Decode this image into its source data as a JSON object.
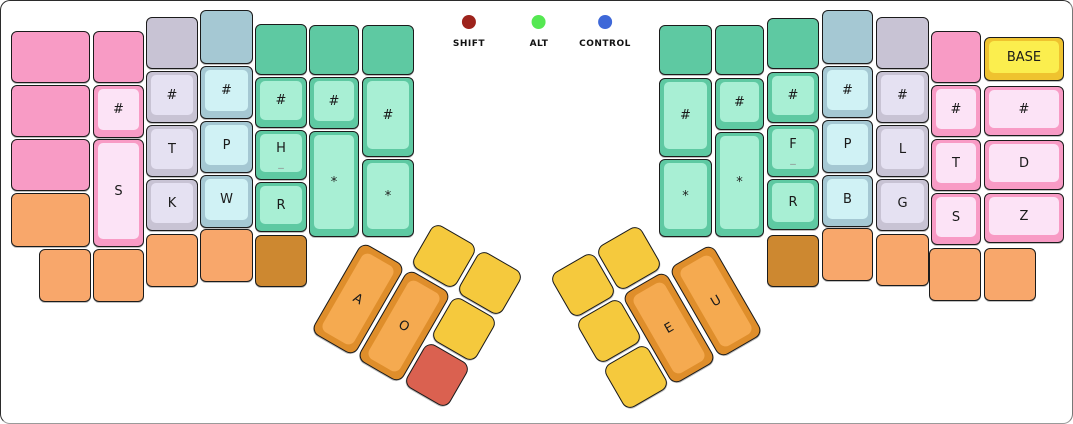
{
  "legend": {
    "indicators": [
      {
        "id": "shift",
        "label": "SHIFT",
        "color": "#9d231c",
        "x": 468
      },
      {
        "id": "alt",
        "label": "ALT",
        "color": "#55e852",
        "x": 538
      },
      {
        "id": "control",
        "label": "CONTROL",
        "color": "#3e68d8",
        "x": 604
      }
    ]
  },
  "palette": {
    "pink": {
      "base": "#f89bc5",
      "top": "#fce3f6"
    },
    "gray": {
      "base": "#c8c3d4",
      "top": "#e5e1f2"
    },
    "blue": {
      "base": "#a5c8d3",
      "top": "#d0f2f5"
    },
    "green": {
      "base": "#5ec9a2",
      "top": "#a8efd4"
    },
    "orange": {
      "base": "#f8a76b",
      "top": "#f8a76b"
    },
    "dorange": {
      "base": "#cd8830",
      "top": "#cd8830"
    },
    "thumb": {
      "base": "#df8e2b",
      "top": "#f5aa50"
    },
    "yellow": {
      "base": "#f5c93d",
      "top": "#f5c93d"
    },
    "red": {
      "base": "#da6150",
      "top": "#da6150"
    },
    "base_key": {
      "base": "#efc32f",
      "top": "#fbee4e"
    }
  },
  "keys": [
    {
      "x": 10,
      "y": 30,
      "w": 79,
      "h": 52,
      "c": "pink",
      "label": ""
    },
    {
      "x": 10,
      "y": 84,
      "w": 79,
      "h": 52,
      "c": "pink",
      "label": ""
    },
    {
      "x": 10,
      "y": 138,
      "w": 79,
      "h": 52,
      "c": "pink",
      "label": ""
    },
    {
      "x": 10,
      "y": 192,
      "w": 79,
      "h": 54,
      "c": "orange",
      "label": ""
    },
    {
      "x": 38,
      "y": 248,
      "w": 52,
      "h": 53,
      "c": "orange",
      "label": ""
    },
    {
      "x": 92,
      "y": 248,
      "w": 51,
      "h": 53,
      "c": "orange",
      "label": ""
    },
    {
      "x": 92,
      "y": 30,
      "w": 51,
      "h": 52,
      "c": "pink",
      "label": ""
    },
    {
      "x": 92,
      "y": 84,
      "w": 51,
      "h": 53,
      "c": "pink",
      "label": "#"
    },
    {
      "x": 92,
      "y": 138,
      "w": 51,
      "h": 108,
      "c": "pink",
      "label": "S"
    },
    {
      "x": 145,
      "y": 16,
      "w": 52,
      "h": 52,
      "c": "gray",
      "label": ""
    },
    {
      "x": 145,
      "y": 70,
      "w": 52,
      "h": 52,
      "c": "gray",
      "label": "#"
    },
    {
      "x": 145,
      "y": 124,
      "w": 52,
      "h": 52,
      "c": "gray",
      "label": "T"
    },
    {
      "x": 145,
      "y": 178,
      "w": 52,
      "h": 52,
      "c": "gray",
      "label": "K"
    },
    {
      "x": 145,
      "y": 233,
      "w": 52,
      "h": 53,
      "c": "orange",
      "label": ""
    },
    {
      "x": 199,
      "y": 9,
      "w": 53,
      "h": 54,
      "c": "blue",
      "label": ""
    },
    {
      "x": 199,
      "y": 65,
      "w": 53,
      "h": 53,
      "c": "blue",
      "label": "#"
    },
    {
      "x": 199,
      "y": 120,
      "w": 53,
      "h": 52,
      "c": "blue",
      "label": "P"
    },
    {
      "x": 199,
      "y": 174,
      "w": 53,
      "h": 53,
      "c": "blue",
      "label": "W"
    },
    {
      "x": 199,
      "y": 228,
      "w": 53,
      "h": 53,
      "c": "orange",
      "label": ""
    },
    {
      "x": 254,
      "y": 23,
      "w": 52,
      "h": 51,
      "c": "green",
      "label": ""
    },
    {
      "x": 254,
      "y": 76,
      "w": 52,
      "h": 51,
      "c": "green",
      "label": "#"
    },
    {
      "x": 254,
      "y": 129,
      "w": 52,
      "h": 50,
      "c": "green",
      "label": "H",
      "sub": "_"
    },
    {
      "x": 254,
      "y": 181,
      "w": 52,
      "h": 50,
      "c": "green",
      "label": "R"
    },
    {
      "x": 254,
      "y": 234,
      "w": 52,
      "h": 52,
      "c": "dorange",
      "label": ""
    },
    {
      "x": 308,
      "y": 24,
      "w": 50,
      "h": 50,
      "c": "green",
      "label": ""
    },
    {
      "x": 308,
      "y": 76,
      "w": 50,
      "h": 52,
      "c": "green",
      "label": "#"
    },
    {
      "x": 308,
      "y": 130,
      "w": 50,
      "h": 106,
      "c": "green",
      "label": "*"
    },
    {
      "x": 361,
      "y": 24,
      "w": 52,
      "h": 50,
      "c": "green",
      "label": ""
    },
    {
      "x": 361,
      "y": 76,
      "w": 52,
      "h": 80,
      "c": "green",
      "label": "#"
    },
    {
      "x": 361,
      "y": 158,
      "w": 52,
      "h": 78,
      "c": "green",
      "label": "*"
    },
    {
      "x": 332,
      "y": 246,
      "w": 50,
      "h": 104,
      "c": "thumb",
      "label": "A",
      "rot": 30
    },
    {
      "x": 378,
      "y": 273,
      "w": 50,
      "h": 104,
      "c": "thumb",
      "label": "O",
      "rot": 30
    },
    {
      "x": 418,
      "y": 230,
      "w": 50,
      "h": 50,
      "c": "yellow",
      "label": "",
      "rot": 30
    },
    {
      "x": 464,
      "y": 257,
      "w": 50,
      "h": 50,
      "c": "yellow",
      "label": "",
      "rot": 30
    },
    {
      "x": 438,
      "y": 303,
      "w": 50,
      "h": 50,
      "c": "yellow",
      "label": "",
      "rot": 30
    },
    {
      "x": 411,
      "y": 349,
      "w": 50,
      "h": 50,
      "c": "red",
      "label": "",
      "rot": 30
    },
    {
      "x": 557,
      "y": 259,
      "w": 50,
      "h": 50,
      "c": "yellow",
      "label": "",
      "rot": -30
    },
    {
      "x": 603,
      "y": 232,
      "w": 50,
      "h": 50,
      "c": "yellow",
      "label": "",
      "rot": -30
    },
    {
      "x": 583,
      "y": 305,
      "w": 50,
      "h": 50,
      "c": "yellow",
      "label": "",
      "rot": -30
    },
    {
      "x": 610,
      "y": 351,
      "w": 50,
      "h": 50,
      "c": "yellow",
      "label": "",
      "rot": -30
    },
    {
      "x": 643,
      "y": 275,
      "w": 50,
      "h": 104,
      "c": "thumb",
      "label": "E",
      "rot": -30
    },
    {
      "x": 690,
      "y": 248,
      "w": 50,
      "h": 104,
      "c": "thumb",
      "label": "U",
      "rot": -30
    },
    {
      "x": 658,
      "y": 24,
      "w": 53,
      "h": 50,
      "c": "green",
      "label": ""
    },
    {
      "x": 658,
      "y": 77,
      "w": 53,
      "h": 79,
      "c": "green",
      "label": "#"
    },
    {
      "x": 658,
      "y": 158,
      "w": 53,
      "h": 78,
      "c": "green",
      "label": "*"
    },
    {
      "x": 714,
      "y": 24,
      "w": 49,
      "h": 50,
      "c": "green",
      "label": ""
    },
    {
      "x": 714,
      "y": 77,
      "w": 49,
      "h": 52,
      "c": "green",
      "label": "#"
    },
    {
      "x": 714,
      "y": 131,
      "w": 49,
      "h": 105,
      "c": "green",
      "label": "*"
    },
    {
      "x": 766,
      "y": 17,
      "w": 52,
      "h": 51,
      "c": "green",
      "label": ""
    },
    {
      "x": 766,
      "y": 71,
      "w": 52,
      "h": 51,
      "c": "green",
      "label": "#"
    },
    {
      "x": 766,
      "y": 124,
      "w": 52,
      "h": 52,
      "c": "green",
      "label": "F",
      "sub": "_"
    },
    {
      "x": 766,
      "y": 178,
      "w": 52,
      "h": 51,
      "c": "green",
      "label": "R"
    },
    {
      "x": 766,
      "y": 234,
      "w": 52,
      "h": 52,
      "c": "dorange",
      "label": ""
    },
    {
      "x": 821,
      "y": 9,
      "w": 51,
      "h": 54,
      "c": "blue",
      "label": ""
    },
    {
      "x": 821,
      "y": 65,
      "w": 51,
      "h": 52,
      "c": "blue",
      "label": "#"
    },
    {
      "x": 821,
      "y": 119,
      "w": 51,
      "h": 53,
      "c": "blue",
      "label": "P"
    },
    {
      "x": 821,
      "y": 174,
      "w": 51,
      "h": 52,
      "c": "blue",
      "label": "B"
    },
    {
      "x": 821,
      "y": 227,
      "w": 51,
      "h": 53,
      "c": "orange",
      "label": ""
    },
    {
      "x": 875,
      "y": 16,
      "w": 53,
      "h": 52,
      "c": "gray",
      "label": ""
    },
    {
      "x": 875,
      "y": 70,
      "w": 53,
      "h": 52,
      "c": "gray",
      "label": "#"
    },
    {
      "x": 875,
      "y": 124,
      "w": 53,
      "h": 52,
      "c": "gray",
      "label": "L"
    },
    {
      "x": 875,
      "y": 178,
      "w": 53,
      "h": 52,
      "c": "gray",
      "label": "G"
    },
    {
      "x": 875,
      "y": 233,
      "w": 53,
      "h": 52,
      "c": "orange",
      "label": ""
    },
    {
      "x": 930,
      "y": 30,
      "w": 50,
      "h": 52,
      "c": "pink",
      "label": ""
    },
    {
      "x": 930,
      "y": 84,
      "w": 50,
      "h": 52,
      "c": "pink",
      "label": "#"
    },
    {
      "x": 930,
      "y": 138,
      "w": 50,
      "h": 52,
      "c": "pink",
      "label": "T"
    },
    {
      "x": 930,
      "y": 192,
      "w": 50,
      "h": 52,
      "c": "pink",
      "label": "S"
    },
    {
      "x": 928,
      "y": 247,
      "w": 52,
      "h": 53,
      "c": "orange",
      "label": ""
    },
    {
      "x": 983,
      "y": 36,
      "w": 80,
      "h": 44,
      "c": "base_key",
      "label": "BASE"
    },
    {
      "x": 983,
      "y": 85,
      "w": 80,
      "h": 50,
      "c": "pink",
      "label": "#"
    },
    {
      "x": 983,
      "y": 139,
      "w": 80,
      "h": 50,
      "c": "pink",
      "label": "D"
    },
    {
      "x": 983,
      "y": 192,
      "w": 80,
      "h": 50,
      "c": "pink",
      "label": "Z"
    },
    {
      "x": 983,
      "y": 247,
      "w": 52,
      "h": 53,
      "c": "orange",
      "label": ""
    }
  ]
}
